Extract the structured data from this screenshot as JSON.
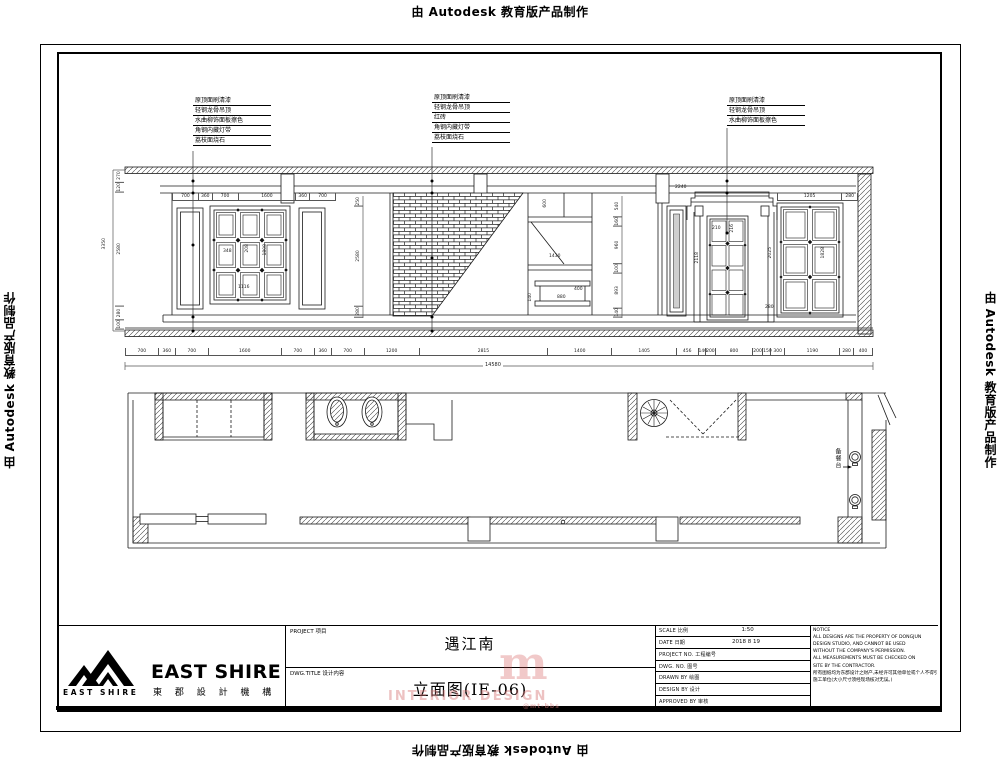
{
  "page": {
    "edge_label": "由 Autodesk 教育版产品制作"
  },
  "annotations": {
    "left": [
      "原顶面刷清漆",
      "轻钢龙骨吊顶",
      "水曲柳饰面板擦色",
      "角钢内藏灯带",
      "荔枝面烧石"
    ],
    "middle": [
      "原顶面刷清漆",
      "轻钢龙骨吊顶",
      "红砖",
      "角钢内藏灯带",
      "荔枝面烧石"
    ],
    "right": [
      "原顶面刷清漆",
      "轻钢龙骨吊顶",
      "水曲柳饰面板擦色"
    ]
  },
  "elevation": {
    "top_left_chain": [
      "700",
      "360",
      "700",
      "1600",
      "360",
      "700"
    ],
    "top_right_chain": [
      "1205",
      "280"
    ],
    "left_chain": [
      "270",
      "120",
      "2580",
      "280",
      "100"
    ],
    "left_total": "3350",
    "mid_chain": [
      "250",
      "2580",
      "280"
    ],
    "bar_chain": [
      "540",
      "160",
      "960",
      "100",
      "893",
      "140"
    ],
    "bottom_chain": [
      "700",
      "360",
      "700",
      "1600",
      "700",
      "360",
      "700",
      "1200",
      "2815",
      "1400",
      "1405",
      "456",
      "140",
      "200",
      "800",
      "200",
      "150",
      "300",
      "1190",
      "280",
      "400"
    ],
    "bottom_total": "14580",
    "grid_dims": [
      "348",
      "208",
      "1808",
      "1116"
    ],
    "counter_dims": [
      "600",
      "1430",
      "880",
      "400",
      "140"
    ],
    "door_dims": [
      "2240",
      "210",
      "216",
      "2118"
    ],
    "window_dims": [
      "2025",
      "1828",
      "280"
    ]
  },
  "plan": {
    "serving_counter_label": "备餐台"
  },
  "titleblock": {
    "logo_main": "EAST SHIRE",
    "logo_sub": "EAST SHIRE",
    "logo_cn": "東 郡 設 計 機 構",
    "project_label": "PROJECT 项目",
    "project_value": "遇江南",
    "dwg_title_label": "DWG.TITLE 设计内容",
    "dwg_title_value": "立面图(IE-06)",
    "fields": [
      {
        "label": "SCALE 比例",
        "value": "1:50"
      },
      {
        "label": "DATE 日期",
        "value": "2018 8 19"
      },
      {
        "label": "PROJECT NO. 工程编号",
        "value": ""
      },
      {
        "label": "DWG. NO. 图号",
        "value": ""
      },
      {
        "label": "DRAWN BY 绘图",
        "value": ""
      },
      {
        "label": "DESIGN BY 设计",
        "value": ""
      },
      {
        "label": "APPROVED BY 审核",
        "value": ""
      }
    ],
    "notice": [
      "NOTICE",
      "ALL DESIGNS ARE THE PROPERTY OF DONGJUN",
      "DESIGN STUDIO, AND CANNOT BE USED",
      "WITHOUT THE COMPANY'S PERMISSION.",
      "ALL MEASUREMENTS MUST BE CHECKED ON",
      "SITE BY THE CONTRACTOR.",
      "所有图纸均为东郡设计之财产,未经许可其他单位或个人不得引用本图内容。",
      "施工单位(大小尺寸须经现场核对无误。)"
    ]
  },
  "watermark": {
    "line1": "INTERIOR DESIGN",
    "line2": "@mt-bbs",
    "mark": "m"
  }
}
